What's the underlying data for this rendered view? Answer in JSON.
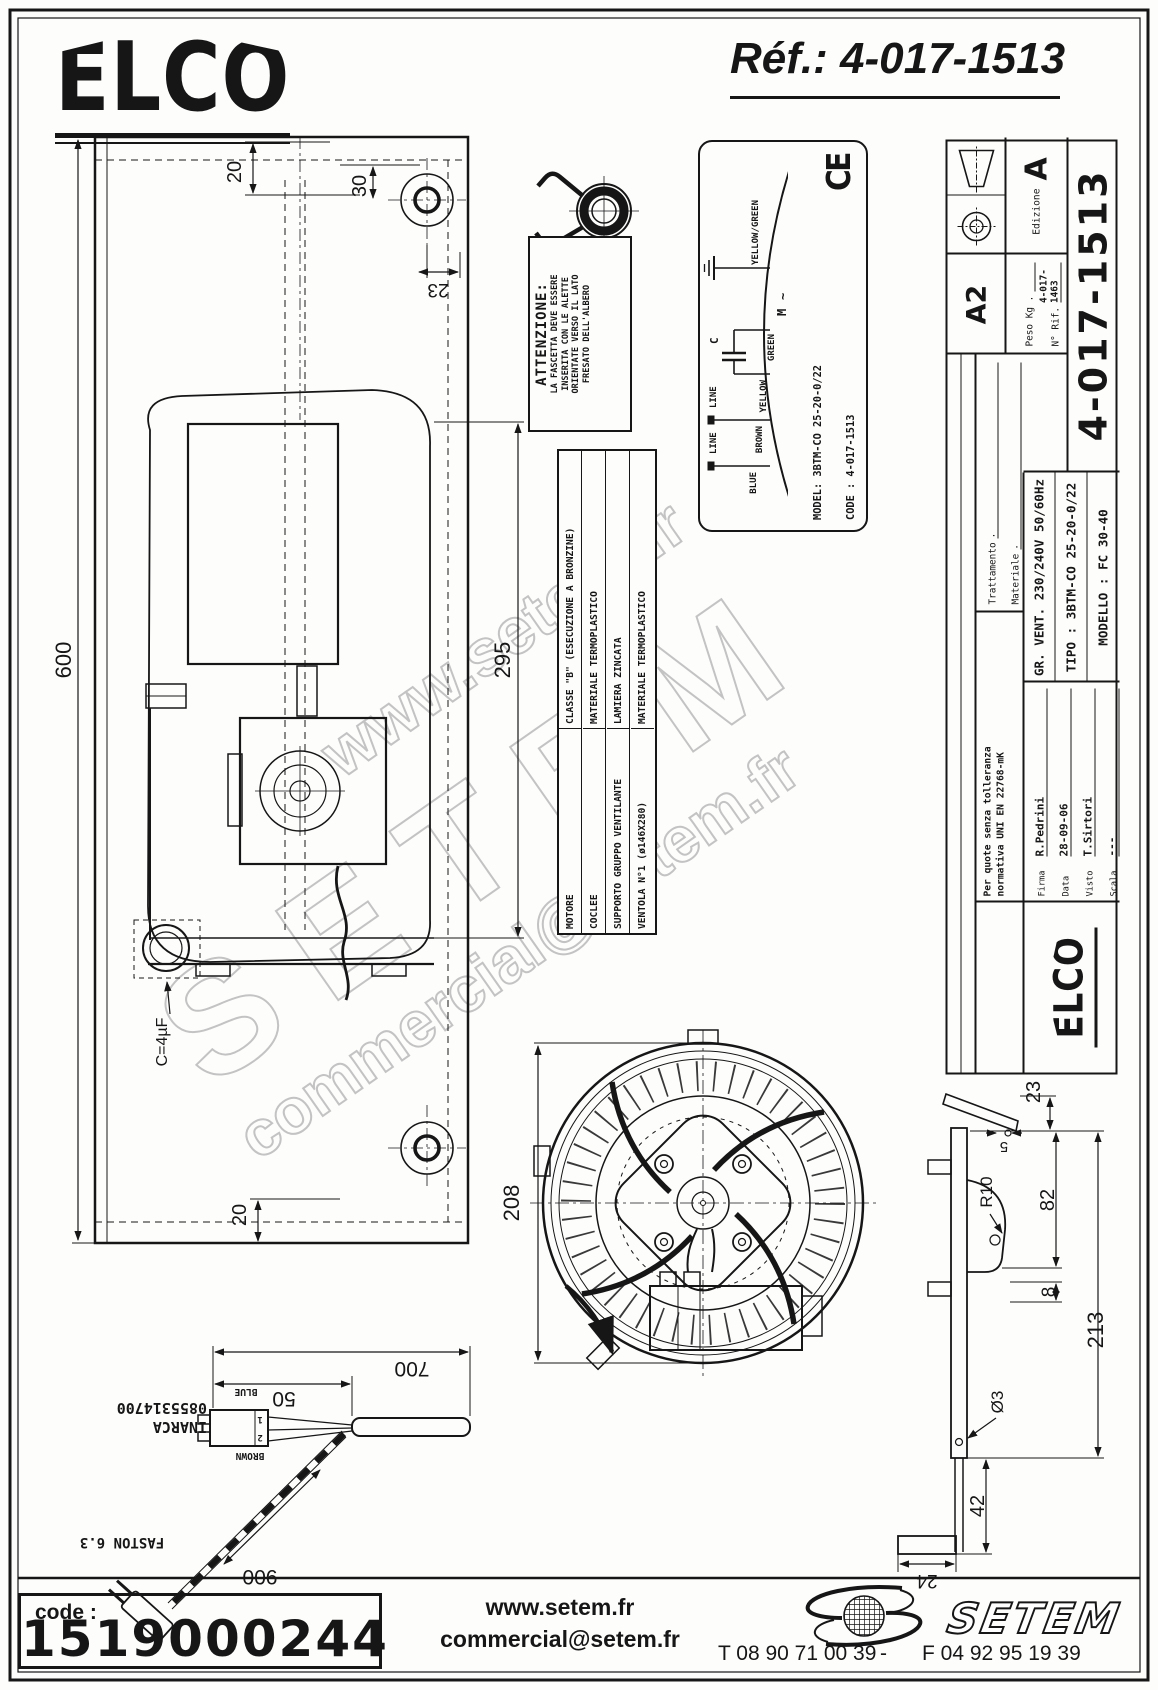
{
  "header": {
    "logo": "ELCO",
    "ref": "Réf.: 4-017-1513"
  },
  "watermarks": {
    "line1": "www.setem.fr",
    "line2": "SETEM",
    "line3": "commercial@setem.fr"
  },
  "main_view": {
    "dim_600": "600",
    "dim_20_top": "20",
    "dim_30": "30",
    "dim_23": "23",
    "dim_295": "295",
    "capacitor_label": "C=4µF",
    "dim_20_bottom": "20"
  },
  "attention_note": {
    "title": "ATTENZIONE:",
    "line1": "LA FASCETTA DEVE ESSERE",
    "line2": "INSERITA CON LE ALETTE",
    "line3": "ORIENTATE VERSO IL LATO",
    "line4": "FRESATO DELL'ALBERO"
  },
  "materials_table": {
    "rows": [
      {
        "label": "MOTORE",
        "value": "CLASSE \"B\" (ESECUZIONE A BRONZINE)"
      },
      {
        "label": "COCLEE",
        "value": "MATERIALE TERMOPLASTICO"
      },
      {
        "label": "SUPPORTO GRUPPO VENTILANTE",
        "value": "LAMIERA ZINCATA"
      },
      {
        "label": "VENTOLA N°1 (ø146X280)",
        "value": "MATERIALE TERMOPLASTICO"
      }
    ]
  },
  "spec_label": {
    "wiring": {
      "wire1": "BLUE",
      "wire2": "BROWN",
      "wire3": "YELLOW",
      "wire4": "GREEN",
      "wire5": "YELLOW/GREEN",
      "line1": "LINE",
      "line2": "LINE",
      "cap": "C",
      "motor": "M",
      "ac": "~"
    },
    "model_line": "MODEL: 3BTM-CO 25-20-0/22",
    "code_line": "CODE : 4-017-1513",
    "elec_line1": "230/240V~ 50/60Hz  0,40Amax.",
    "elec_line2": "85Win-max.  950Rpm  TH.PROT.",
    "elec_line3": "INS.CL.B   C=4µF   450VL",
    "part_line": "( BTNM41TB0052S )",
    "mod_line": "MOD. FC 30-40   DATA",
    "ce": "CE"
  },
  "title_block": {
    "tolerance_line1": "Per quote senza tolleranza",
    "tolerance_line2": "normativa UNI EN 22768-mK",
    "trattamento_label": "Trattamento",
    "trattamento_value": ".",
    "materiale_label": "Materiale",
    "materiale_value": ".",
    "firma_label": "Firma",
    "firma_value": "R.Pedrini",
    "data_label": "Data",
    "data_value": "28-09-06",
    "visto_label": "Visto",
    "visto_value": "T.Sirtori",
    "scala_label": "Scala",
    "scala_value": "---",
    "logo": "ELCO",
    "product_line": "GR. VENT. 230/240V  50/60Hz",
    "tipo_line": "TIPO : 3BTM-CO 25-20-0/22",
    "modello_line": "MODELLO : FC 30-40",
    "format": "A2",
    "edizione_label": "Edizione",
    "edizione_value": "A",
    "peso_label": "Peso Kg .",
    "rif_label": "N° Rif.",
    "rif_value": "4-017-1463",
    "drawing_number": "4-017-1513"
  },
  "fan_view": {
    "dim_208": "208",
    "dim_23": "23",
    "dim_5": "5",
    "dim_r10": "R10",
    "dim_82": "82",
    "dim_8": "8",
    "dim_213": "213",
    "dim_o3": "Ø3",
    "dim_42": "42",
    "dim_24": "24"
  },
  "cable_view": {
    "dim_700": "700",
    "dim_50": "50",
    "dim_900": "900",
    "wire_blue": "BLUE",
    "wire_brown": "BROWN",
    "pin1": "1",
    "pin2": "2",
    "connector_line1": "INARCA",
    "connector_line2": "0855314700",
    "terminal": "FASTON 6.3"
  },
  "footer": {
    "code_label": "code :",
    "code_value": "1519000244",
    "website": "www.setem.fr",
    "email": "commercial@setem.fr",
    "phone": "T 08 90 71 00 39",
    "separator": "-",
    "fax": "F 04 92 95 19 39",
    "brand": "SETEM"
  }
}
